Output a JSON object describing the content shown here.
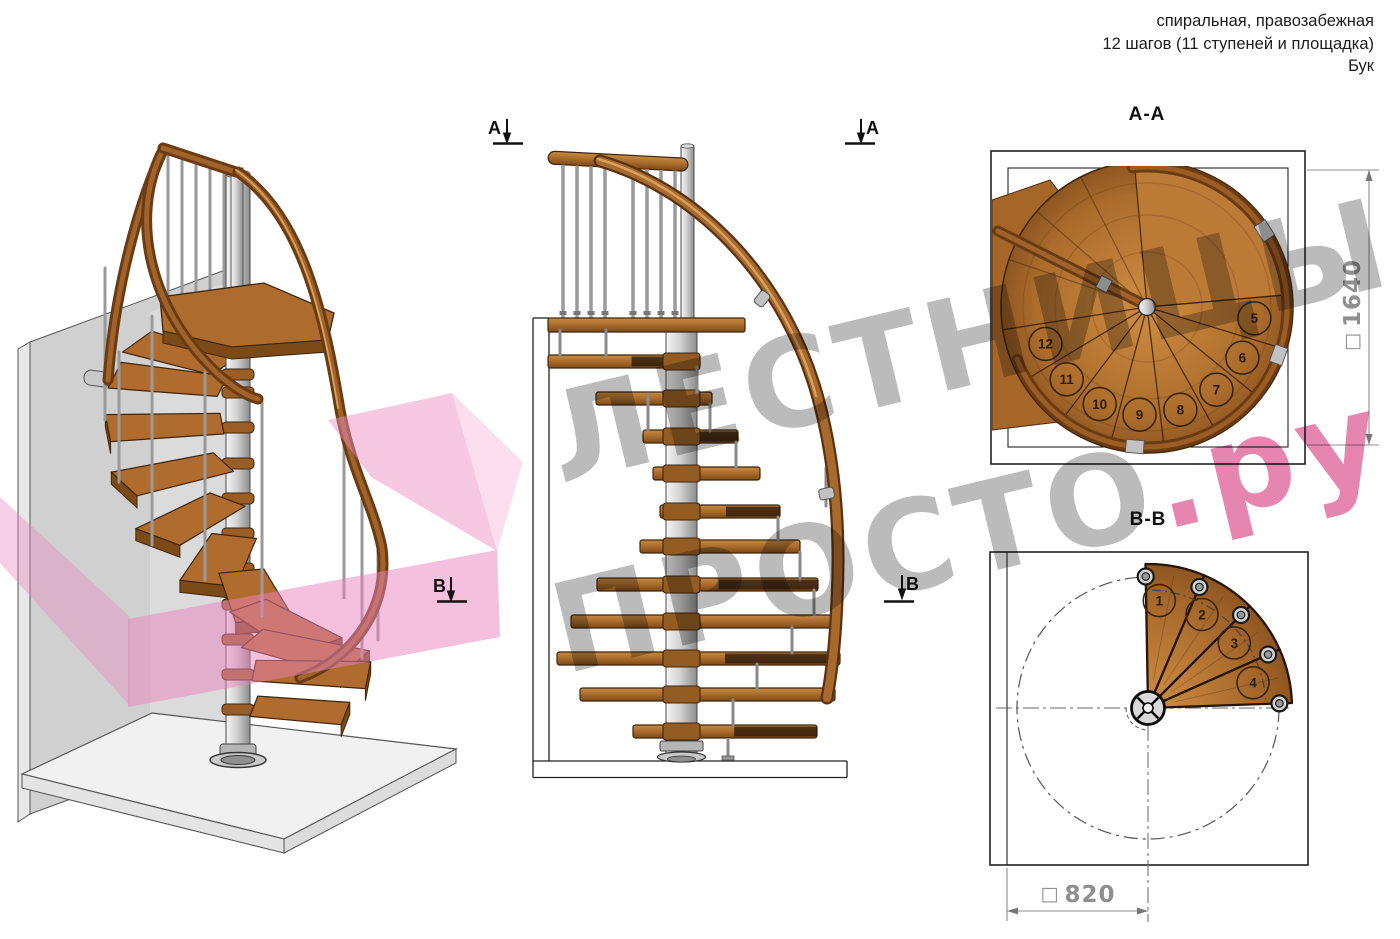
{
  "header": {
    "line1": "спиральная, правозабежная",
    "line2": "12 шагов (11 ступеней и площадка)",
    "line3": "Бук"
  },
  "watermark": {
    "line1": "ЛЕСТНИЦЫ",
    "line2_gray": "ПРОСТО",
    "line2_pink": ".ру"
  },
  "views": {
    "perspective": {
      "description_icon": "spiral-staircase-3d"
    },
    "elevation": {
      "marker_a": "А",
      "marker_b": "В"
    },
    "plan_aa": {
      "title": "А-А",
      "dimension": {
        "square": "□",
        "value": "1640"
      },
      "step_numbers": [
        5,
        6,
        7,
        8,
        9,
        10,
        11,
        12
      ]
    },
    "plan_bb": {
      "title": "В-В",
      "dimension": {
        "square": "□",
        "value": "820"
      },
      "step_numbers": [
        1,
        2,
        3,
        4
      ]
    }
  },
  "colors": {
    "wood": "#a9682c",
    "wood_dark": "#6f3f12",
    "wood_light": "#c8883f",
    "metal": "#c9c9c9",
    "wall": "#d0d0d0",
    "floor": "#f1f1f1",
    "pink_plane": "#ee8cc0",
    "watermark_gray": "rgba(138,138,138,0.58)",
    "watermark_pink": "rgba(214,58,126,0.62)",
    "dimension_gray": "#8f8f8f",
    "line": "#222222"
  }
}
